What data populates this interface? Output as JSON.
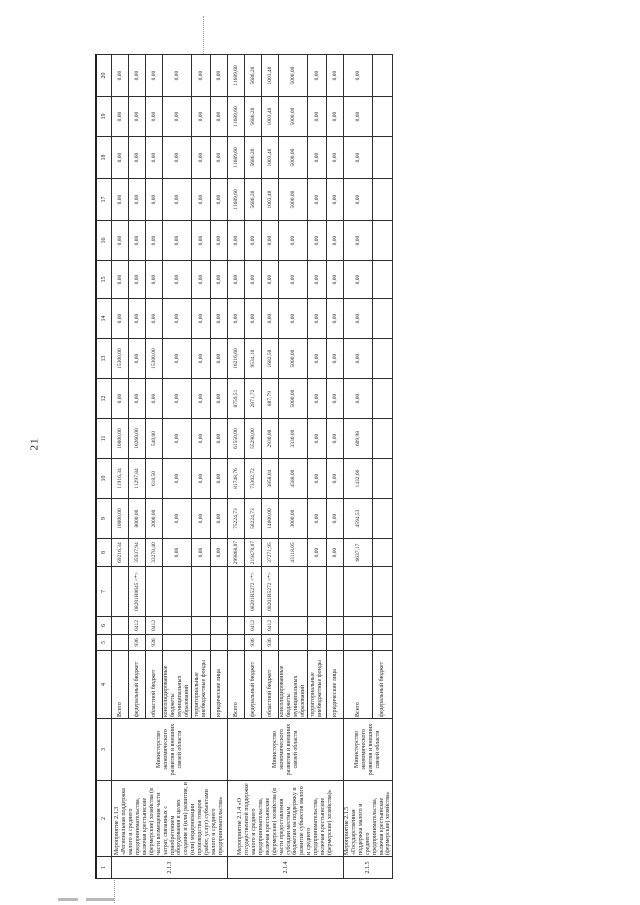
{
  "page": {
    "number": "21"
  },
  "table": {
    "column_numbers": [
      "1",
      "2",
      "3",
      "4",
      "5",
      "6",
      "7",
      "8",
      "9",
      "10",
      "11",
      "12",
      "13",
      "14",
      "15",
      "16",
      "17",
      "18",
      "19",
      "20"
    ],
    "budget_row_labels": {
      "total": "Всего",
      "federal": "федеральный бюджет",
      "regional": "областной бюджет",
      "consolidated": "консолидированные бюджеты муниципальных образований",
      "territorial": "территориальные внебюджетные фонды",
      "legal": "юридические лица"
    },
    "groups": [
      {
        "id": "2.1.3",
        "name": "Мероприятие 2.1.3 «Региональная поддержка малого и среднего предпринимательства, включая крестьянские (фермерские) хозяйства (в части возмещения части затрат, связанных с приобретением оборудования в целях создания и (или) развития, и (или) модернизации производства товаров (работ, услуг) субъектами малого и среднего предпринимательства»",
        "executor": "Министерство экономического развития и внешних связей области",
        "rows": [
          {
            "budget": "Всего",
            "grbs": "",
            "rz": "",
            "csr": "",
            "values": [
              "69216,34",
              "10000,00",
              "11916,34",
              "10800,00",
              "0,00",
              "15300,00",
              "0,00",
              "0,00",
              "0,00",
              "0,00",
              "0,00",
              "0,00",
              "0,00"
            ]
          },
          {
            "budget": "федеральный бюджет",
            "grbs": "936",
            "rz": "0412",
            "csr": "08201R0645 <*>",
            "values": [
              "35937,94",
              "8000,00",
              "11297,84",
              "10260,00",
              "0,00",
              "0,00",
              "0,00",
              "0,00",
              "0,00",
              "0,00",
              "0,00",
              "0,00",
              "0,00"
            ]
          },
          {
            "budget": "областной бюджет",
            "grbs": "936",
            "rz": "0412",
            "csr": "",
            "values": [
              "33278,40",
              "2000,00",
              "618,50",
              "540,00",
              "0,00",
              "15300,00",
              "0,00",
              "0,00",
              "0,00",
              "0,00",
              "0,00",
              "0,00",
              "0,00"
            ]
          },
          {
            "budget": "консолидированные бюджеты муниципальных образований",
            "grbs": "",
            "rz": "",
            "csr": "",
            "values": [
              "0,00",
              "0,00",
              "0,00",
              "0,00",
              "0,00",
              "0,00",
              "0,00",
              "0,00",
              "0,00",
              "0,00",
              "0,00",
              "0,00",
              "0,00"
            ]
          },
          {
            "budget": "территориальные внебюджетные фонды",
            "grbs": "",
            "rz": "",
            "csr": "",
            "values": [
              "0,00",
              "0,00",
              "0,00",
              "0,00",
              "0,00",
              "0,00",
              "0,00",
              "0,00",
              "0,00",
              "0,00",
              "0,00",
              "0,00",
              "0,00"
            ]
          },
          {
            "budget": "юридические лица",
            "grbs": "",
            "rz": "",
            "csr": "",
            "values": [
              "0,00",
              "0,00",
              "0,00",
              "0,00",
              "0,00",
              "0,00",
              "0,00",
              "0,00",
              "0,00",
              "0,00",
              "0,00",
              "0,00",
              "0,00"
            ]
          }
        ]
      },
      {
        "id": "2.1.4",
        "name": "Мероприятие 2.1.4 «О государственной поддержке малого и среднего предпринимательства, включая крестьянские (фермерские) хозяйства (в части предоставления субсидии местным бюджетам на поддержку и развитие субъектов малого и среднего предпринимательства, включая крестьянские (фермерские) хозяйства)»",
        "executor": "Министерство экономического развития и внешних связей области",
        "rows": [
          {
            "budget": "Всего",
            "grbs": "",
            "rz": "",
            "csr": "",
            "values": [
              "299868,07",
              "75224,73",
              "81748,76",
              "61550,00",
              "8759,51",
              "16216,60",
              "0,00",
              "0,00",
              "0,00",
              "11689,60",
              "11689,60",
              "11689,60",
              "11689,60"
            ]
          },
          {
            "budget": "федеральный бюджет",
            "grbs": "936",
            "rz": "0412",
            "csr": "08201R5272 <*>",
            "values": [
              "219478,07",
              "58224,73",
              "73302,72",
              "55290,00",
              "2871,72",
              "9534,10",
              "0,00",
              "0,00",
              "0,00",
              "5686,20",
              "5686,20",
              "5686,20",
              "5686,20"
            ]
          },
          {
            "budget": "областной бюджет",
            "grbs": "936",
            "rz": "0412",
            "csr": "08201R5272 <*>",
            "values": [
              "37271,95",
              "14000,00",
              "3858,04",
              "2930,00",
              "887,79",
              "1682,50",
              "0,00",
              "0,00",
              "0,00",
              "1003,40",
              "1003,40",
              "1003,40",
              "1003,40"
            ]
          },
          {
            "budget": "консолидированные бюджеты муниципальных образований",
            "grbs": "",
            "rz": "",
            "csr": "",
            "values": [
              "43118,05",
              "3000,00",
              "4588,00",
              "3330,00",
              "5000,00",
              "5000,00",
              "0,00",
              "0,00",
              "0,00",
              "5000,00",
              "5000,00",
              "5000,00",
              "5000,00"
            ]
          },
          {
            "budget": "территориальные внебюджетные фонды",
            "grbs": "",
            "rz": "",
            "csr": "",
            "values": [
              "0,00",
              "0,00",
              "0,00",
              "0,00",
              "0,00",
              "0,00",
              "0,00",
              "0,00",
              "0,00",
              "0,00",
              "0,00",
              "0,00",
              "0,00"
            ]
          },
          {
            "budget": "юридические лица",
            "grbs": "",
            "rz": "",
            "csr": "",
            "values": [
              "0,00",
              "0,00",
              "0,00",
              "0,00",
              "0,00",
              "0,00",
              "0,00",
              "0,00",
              "0,00",
              "0,00",
              "0,00",
              "0,00",
              "0,00"
            ]
          }
        ]
      },
      {
        "id": "2.1.5",
        "name": "Мероприятие 2.1.5 «Государственная поддержка малого и среднего предпринимательства, включая крестьянские (фермерские) хозяйства»",
        "executor": "Министерство экономического развития и внешних связей области",
        "rows": [
          {
            "budget": "Всего",
            "grbs": "",
            "rz": "",
            "csr": "",
            "values": [
              "6637,17",
              "4594,53",
              "1432,66",
              "609,98",
              "0,00",
              "0,00",
              "0,00",
              "0,00",
              "0,00",
              "0,00",
              "0,00",
              "0,00",
              "0,00"
            ]
          },
          {
            "budget": "федеральный бюджет",
            "grbs": "",
            "rz": "",
            "csr": "",
            "values": [
              "",
              "",
              "",
              "",
              "",
              "",
              "",
              "",
              "",
              "",
              "",
              "",
              ""
            ]
          }
        ]
      }
    ]
  }
}
